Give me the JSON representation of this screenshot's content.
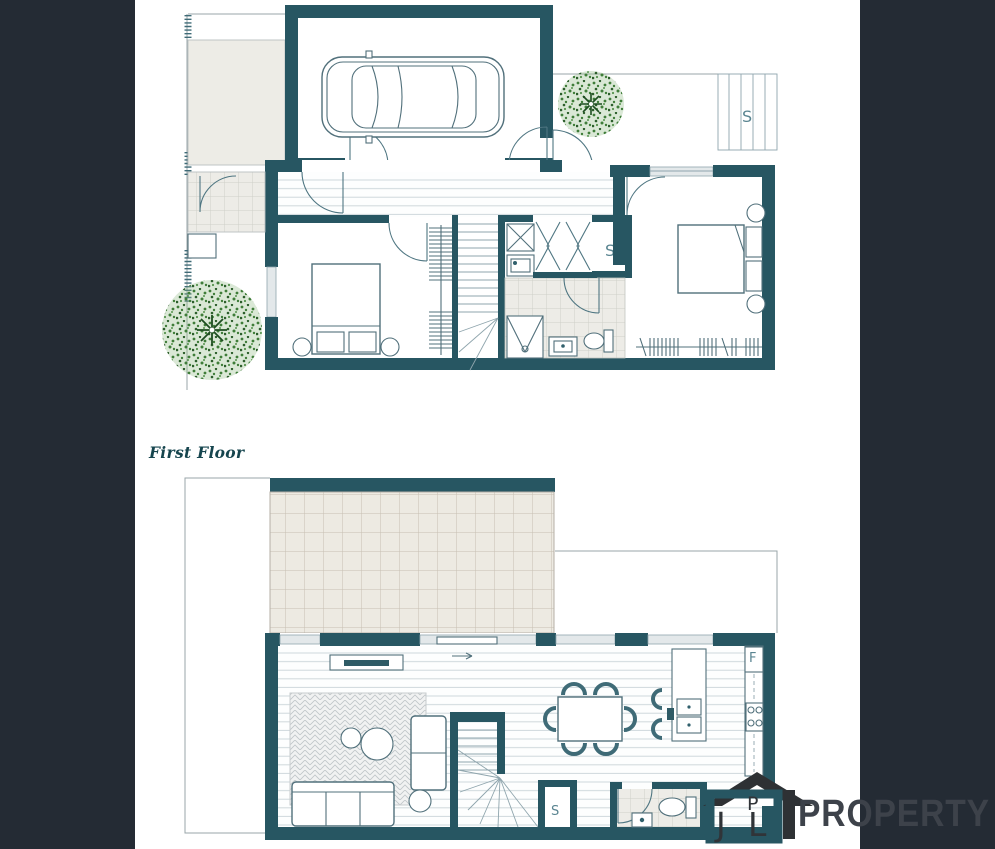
{
  "plan": {
    "first_floor_title": "First Floor",
    "ground_floor": {
      "deck_storage_label": "S",
      "linen_storage_label": "S"
    },
    "first_floor": {
      "storage_label": "S",
      "fridge_label": "F"
    }
  },
  "logo": {
    "letter_j": "J",
    "letter_p": "P",
    "letter_l": "L",
    "wordmark": "PROPERTY"
  },
  "colors": {
    "wall_teal": "#275662",
    "panel_navy": "#242b34",
    "floor_beige": "#edece6",
    "tree_green": "#3f7d39",
    "logo_gray": "#34383d"
  }
}
